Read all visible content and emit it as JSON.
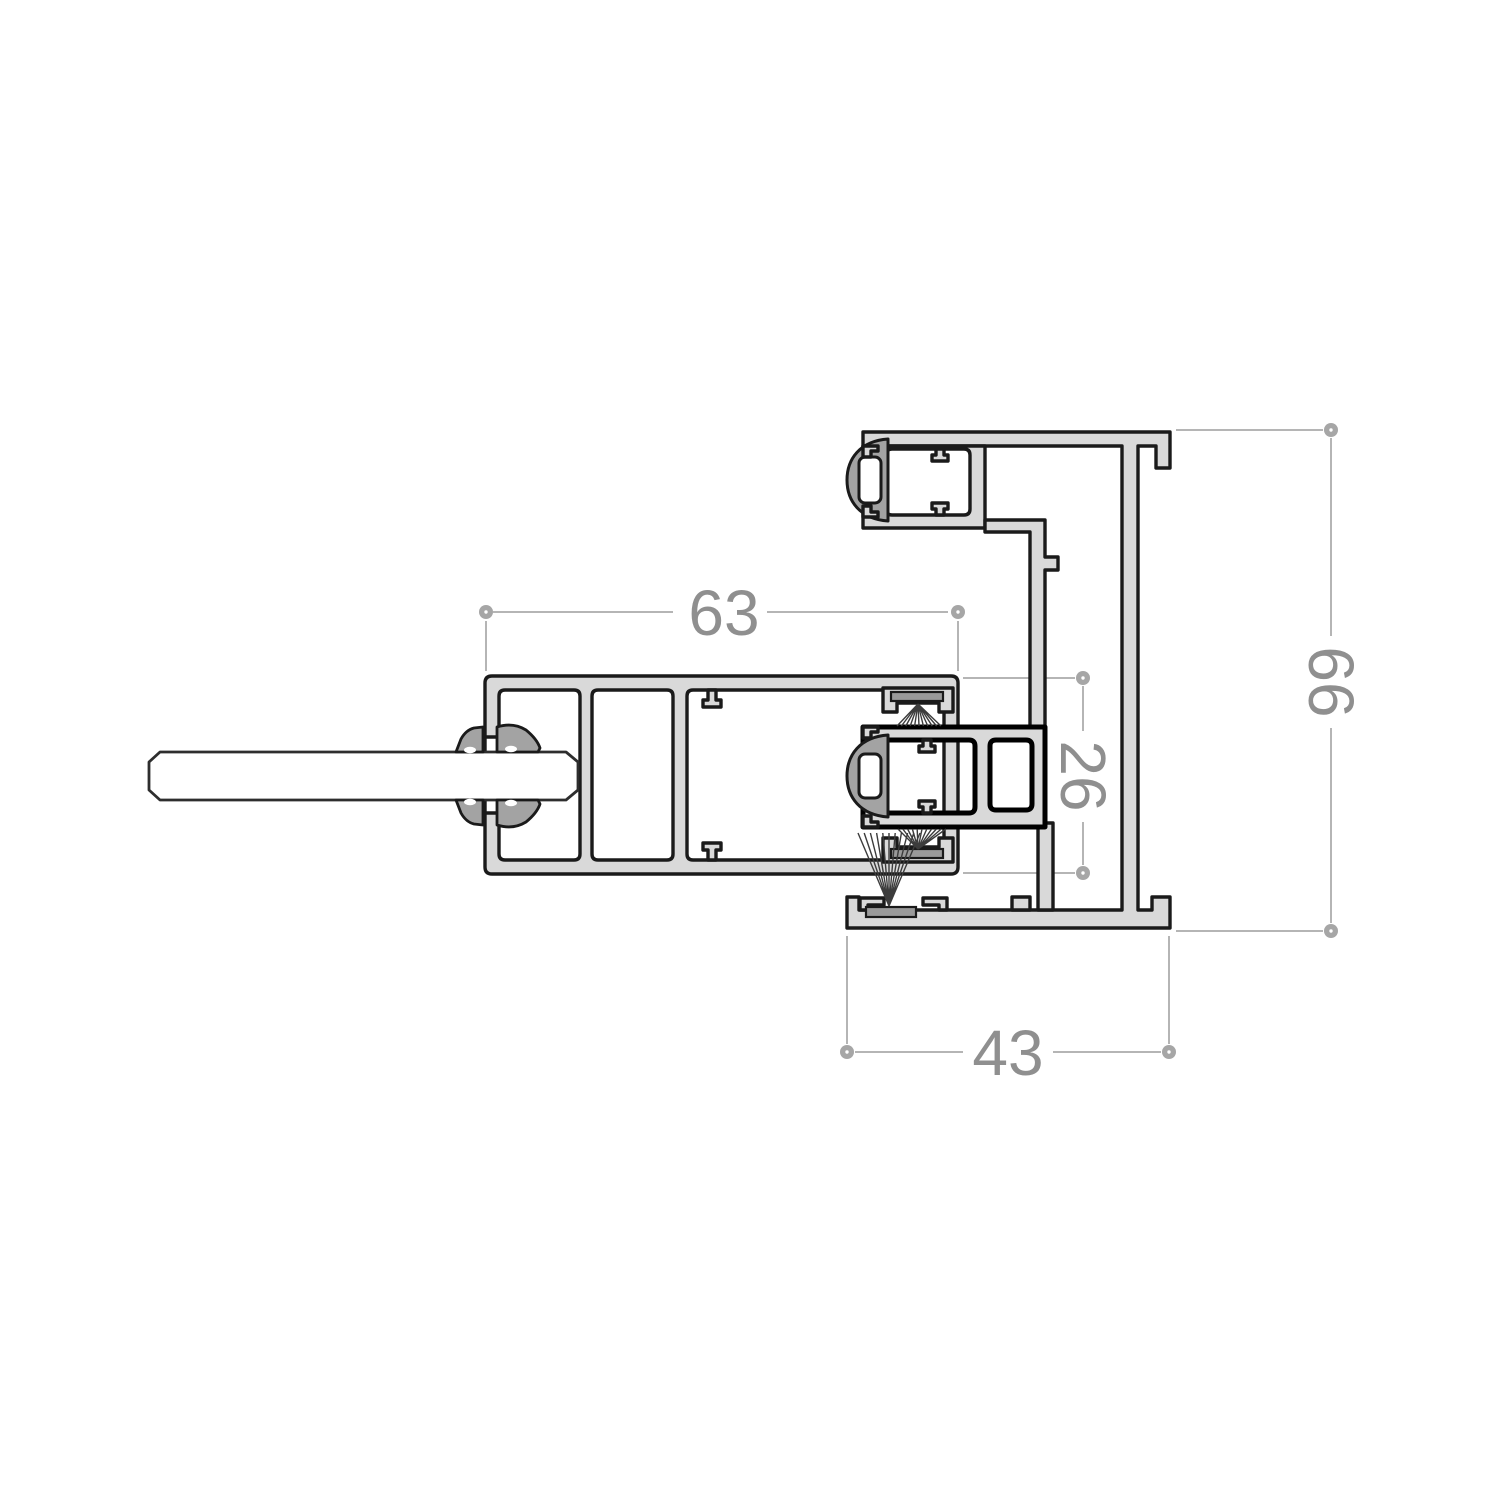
{
  "drawing": {
    "background": "#ffffff",
    "dimensions": {
      "d63": {
        "value": "63",
        "orientation": "horizontal"
      },
      "d66": {
        "value": "66",
        "orientation": "vertical"
      },
      "d26": {
        "value": "26",
        "orientation": "vertical"
      },
      "d43": {
        "value": "43",
        "orientation": "horizontal"
      }
    },
    "colors": {
      "profile_fill": "#d9d9d9",
      "profile_outline": "#1a1a1a",
      "gasket_fill": "#a3a3a3",
      "brush_strip": "#9a9a9a",
      "brush_bristles": "#3c3c3c",
      "dimension_line": "#b5b5b5",
      "dimension_marker": "#a6a6a6",
      "dimension_text": "#8f8f8f",
      "glass_fill": "#ffffff"
    }
  }
}
